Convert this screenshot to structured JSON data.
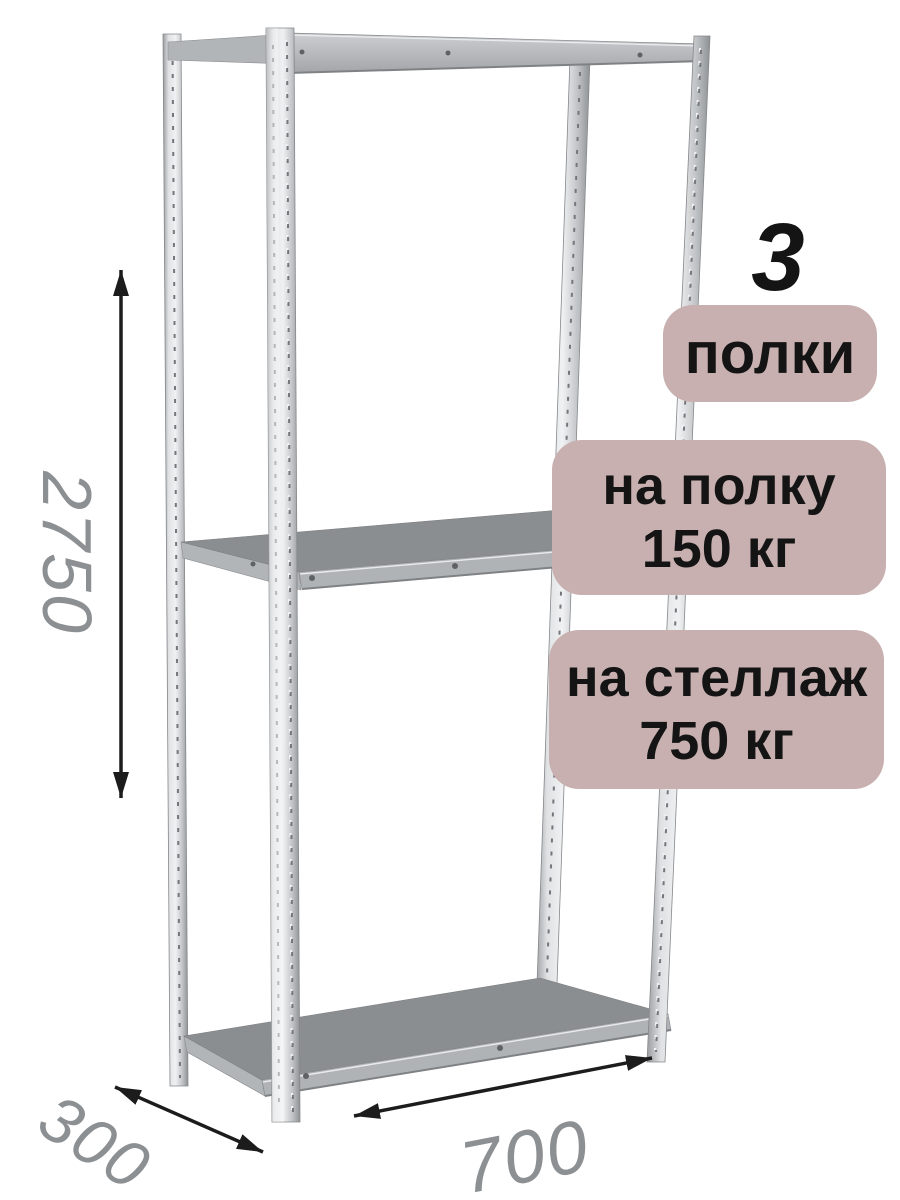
{
  "badges": {
    "count_number": "3",
    "count_label": "полки",
    "per_shelf_line1": "на полку",
    "per_shelf_line2": "150 кг",
    "per_rack_line1": "на стеллаж",
    "per_rack_line2": "750 кг"
  },
  "dimensions": {
    "height_mm": "2750",
    "depth_mm": "300",
    "width_mm": "700"
  },
  "illustration": {
    "type": "metal-shelving-rack",
    "shelves_visible": 3,
    "posts_visible": 4
  },
  "icons": {
    "height_arrow": "double-headed-vertical-arrow",
    "depth_arrow": "double-headed-diagonal-arrow",
    "width_arrow": "double-headed-diagonal-arrow"
  },
  "colors": {
    "background": "#ffffff",
    "badge_bg": "#c8b0b0",
    "badge_text": "#141414",
    "dimension_text": "#8d9092",
    "arrow": "#1c1c1c",
    "shelf_top": "#8b8e91",
    "shelf_edge": "#b0b3b6",
    "metal_light": "#e3e5e7",
    "metal_dark": "#94979a"
  }
}
